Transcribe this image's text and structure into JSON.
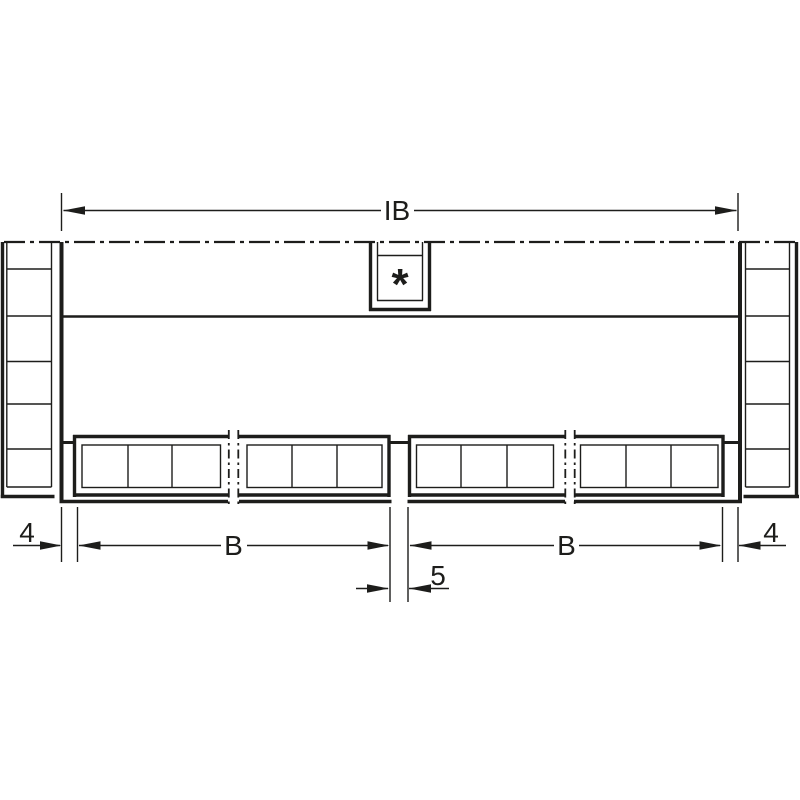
{
  "colors": {
    "line": "#1d1d1b",
    "background": "#ffffff"
  },
  "dimensions": {
    "top": {
      "overall_inner_width": "IB"
    },
    "bottom_row_1": {
      "left_side_clearance": "4",
      "left_drawer_width": "B",
      "right_drawer_width": "B",
      "right_side_clearance": "4"
    },
    "bottom_row_2": {
      "center_clearance": "5"
    }
  },
  "annotations": {
    "footnote_marker": "*"
  }
}
